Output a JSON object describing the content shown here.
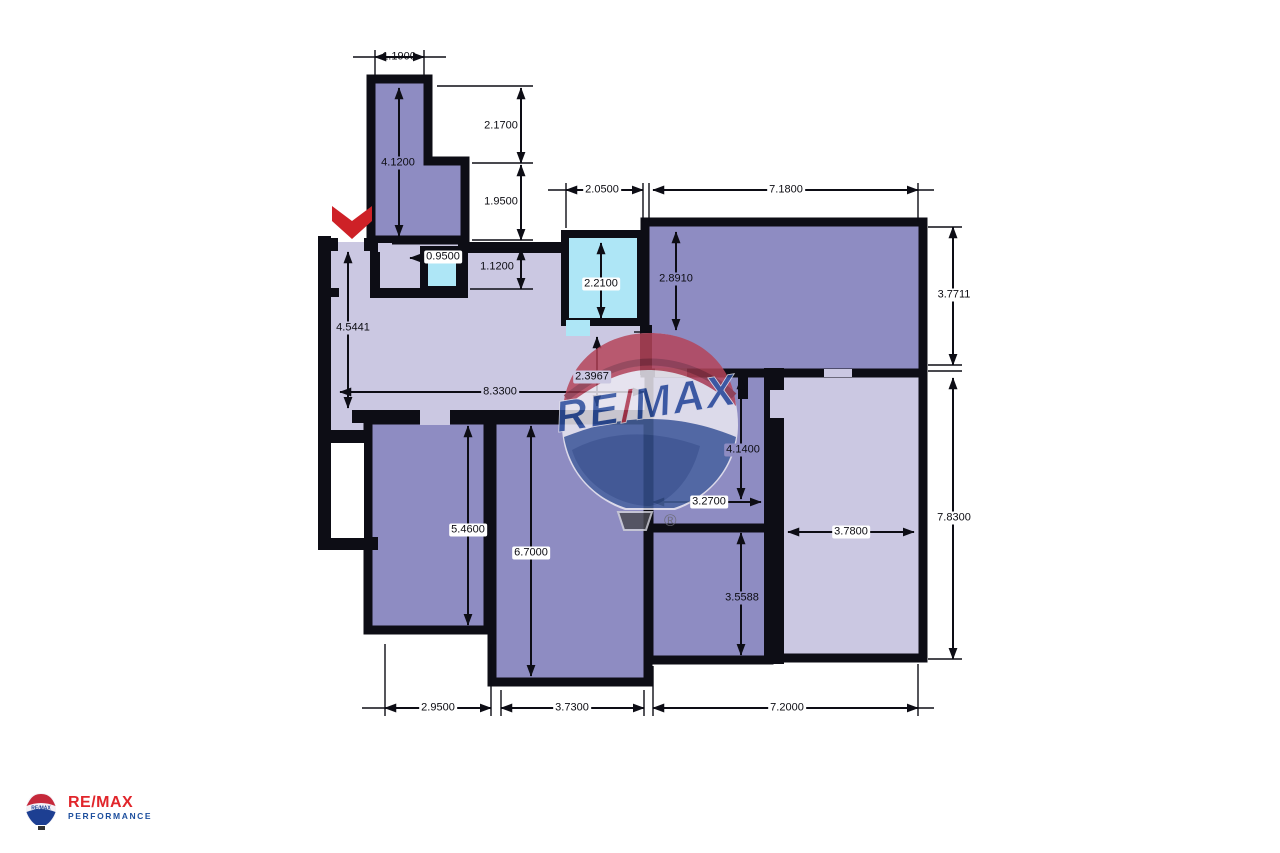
{
  "colors": {
    "wall": "#0d0d15",
    "room_medium": "#8e8cc2",
    "room_light": "#cbc8e2",
    "room_cyan": "#aee6f6",
    "dim": "#0d0d15",
    "arrow_red": "#ce2127",
    "watermark_red": "#b5445a",
    "watermark_red_dark": "#8e3448",
    "watermark_blue": "#47629f",
    "watermark_blue_dark": "#35508e",
    "watermark_text_blue": "#2d4f9e",
    "logo_red": "#e1252b",
    "logo_blue": "#1d4f9e"
  },
  "watermark": {
    "re": "RE",
    "slash": "/",
    "max": "MAX",
    "registered": "®"
  },
  "footer_logo": {
    "wordmark": "RE/MAX",
    "subtitle": "PERFORMANCE"
  },
  "dimensions": [
    {
      "id": "corridor-width-top",
      "label": "1.1900"
    },
    {
      "id": "corridor-length",
      "label": "4.1200"
    },
    {
      "id": "corridor-upper-segment",
      "label": "2.1700"
    },
    {
      "id": "corridor-lower-segment",
      "label": "1.9500"
    },
    {
      "id": "wc-width",
      "label": "0.9500"
    },
    {
      "id": "wc-height",
      "label": "1.1200"
    },
    {
      "id": "kitchen-top-width",
      "label": "2.0500"
    },
    {
      "id": "living-top-width",
      "label": "7.1800"
    },
    {
      "id": "kitchen-inner-height",
      "label": "2.2100"
    },
    {
      "id": "living-left-height",
      "label": "2.8910"
    },
    {
      "id": "living-right-height",
      "label": "3.7711"
    },
    {
      "id": "hall-left-height",
      "label": "4.5441"
    },
    {
      "id": "hall-width",
      "label": "8.3300"
    },
    {
      "id": "hall-right-height",
      "label": "2.3967"
    },
    {
      "id": "room-c-height",
      "label": "4.1400"
    },
    {
      "id": "room-c-width",
      "label": "3.2700"
    },
    {
      "id": "right-room-width",
      "label": "3.7800"
    },
    {
      "id": "right-side-height",
      "label": "7.8300"
    },
    {
      "id": "room-a-height",
      "label": "5.4600"
    },
    {
      "id": "room-b-height",
      "label": "6.7000"
    },
    {
      "id": "room-d-height",
      "label": "3.5588"
    },
    {
      "id": "room-a-bottom-width",
      "label": "2.9500"
    },
    {
      "id": "room-b-bottom-width",
      "label": "3.7300"
    },
    {
      "id": "bottom-right-width",
      "label": "7.2000"
    }
  ]
}
